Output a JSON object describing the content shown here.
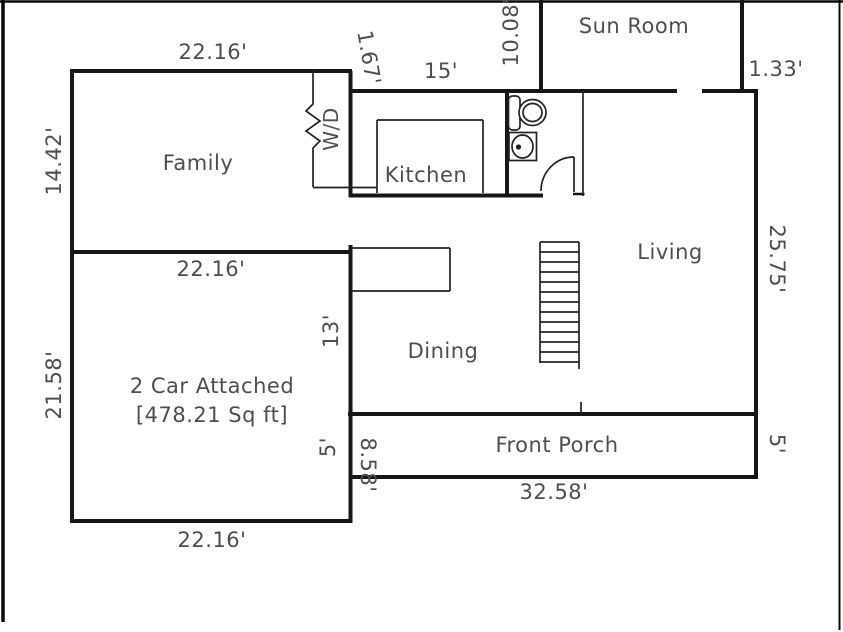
{
  "floor_plan": {
    "colors": {
      "wall": "#161616",
      "border": "#0a0a0a",
      "label": "#4e4e4e",
      "background": "#ffffff"
    },
    "fixtures": [
      "toilet-fixture",
      "sink-fixture",
      "washer-dryer-zigzag-wall",
      "staircase",
      "door-swing"
    ],
    "labels": [
      {
        "id": "dim-family-top",
        "text": "22.16'"
      },
      {
        "id": "dim-jog",
        "text": "1.67'"
      },
      {
        "id": "dim-kitchen-top",
        "text": "15'"
      },
      {
        "id": "dim-sunroom-left",
        "text": "10.08'"
      },
      {
        "id": "room-sunroom",
        "text": "Sun Room"
      },
      {
        "id": "dim-sunroom-jog",
        "text": "1.33'"
      },
      {
        "id": "dim-family-left",
        "text": "14.42'"
      },
      {
        "id": "room-family",
        "text": "Family"
      },
      {
        "id": "label-wd",
        "text": "W/D"
      },
      {
        "id": "room-kitchen",
        "text": "Kitchen"
      },
      {
        "id": "room-living",
        "text": "Living"
      },
      {
        "id": "dim-living-right",
        "text": "25.75'"
      },
      {
        "id": "dim-family-bottom",
        "text": "22.16'"
      },
      {
        "id": "dim-dining-left",
        "text": "13'"
      },
      {
        "id": "room-dining",
        "text": "Dining"
      },
      {
        "id": "dim-garage-left",
        "text": "21.58'"
      },
      {
        "id": "room-garage",
        "text": "2 Car Attached"
      },
      {
        "id": "room-garage-area",
        "text": "[478.21 Sq ft]"
      },
      {
        "id": "dim-porch-left",
        "text": "5'"
      },
      {
        "id": "dim-garage-right",
        "text": "8.58'"
      },
      {
        "id": "room-porch",
        "text": "Front Porch"
      },
      {
        "id": "dim-porch-right",
        "text": "5'"
      },
      {
        "id": "dim-porch-bottom",
        "text": "32.58'"
      },
      {
        "id": "dim-garage-bottom",
        "text": "22.16'"
      }
    ]
  }
}
